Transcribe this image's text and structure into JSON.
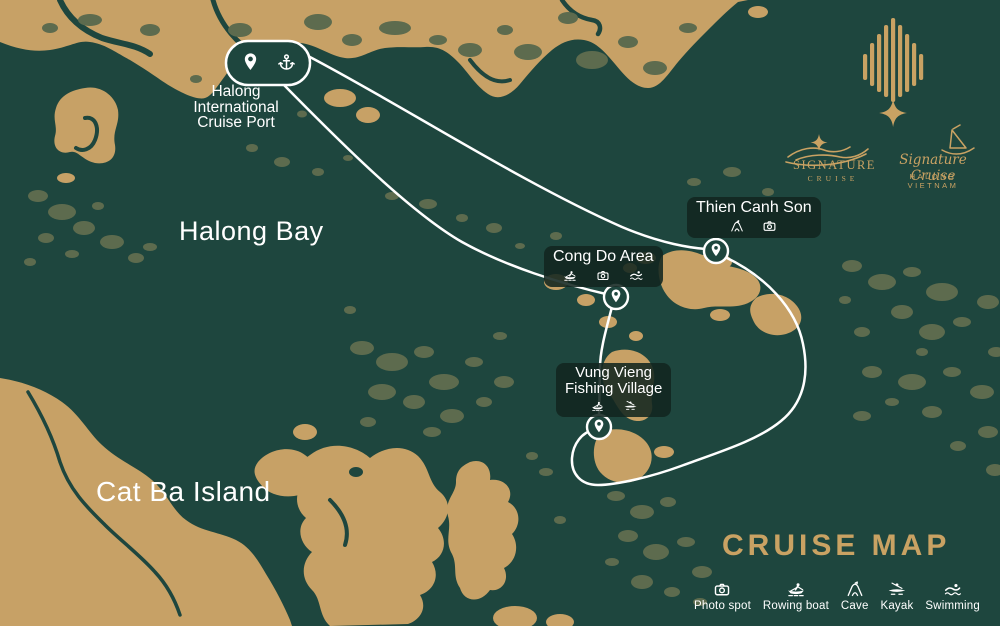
{
  "colors": {
    "sea": "#1e463e",
    "land": "#c7a166",
    "veg": "#5d6b4e",
    "veg2": "#66745a",
    "gold": "#c9a263",
    "route": "#ffffff",
    "labelbg": "rgba(18,38,32,0.88)",
    "text": "#ffffff"
  },
  "title": "CRUISE MAP",
  "regions": {
    "bay": "Halong Bay",
    "island": "Cat Ba Island"
  },
  "port": {
    "line1": "Halong",
    "line2": "International",
    "line3": "Cruise Port",
    "icons": [
      "location-pin",
      "anchor"
    ]
  },
  "stops": [
    {
      "id": "thien-canh-son",
      "name": "Thien Canh Son",
      "activities": [
        "cave",
        "photo-spot"
      ]
    },
    {
      "id": "cong-do-area",
      "name": "Cong Do Area",
      "activities": [
        "rowing-boat",
        "photo-spot",
        "swimming"
      ]
    },
    {
      "id": "vung-vieng",
      "name_line1": "Vung Vieng",
      "name_line2": "Fishing Village",
      "activities": [
        "rowing-boat",
        "kayak"
      ]
    }
  ],
  "legend": {
    "items": [
      {
        "icon": "photo-spot",
        "label": "Photo spot"
      },
      {
        "icon": "rowing-boat",
        "label": "Rowing boat"
      },
      {
        "icon": "cave",
        "label": "Cave"
      },
      {
        "icon": "kayak",
        "label": "Kayak"
      },
      {
        "icon": "swimming",
        "label": "Swimming"
      }
    ]
  },
  "brand": {
    "primary_name": "SIGNATURE",
    "primary_sub": "CRUISE",
    "script_name": "Signature Cruise",
    "script_sub": "HALONG VIETNAM"
  }
}
